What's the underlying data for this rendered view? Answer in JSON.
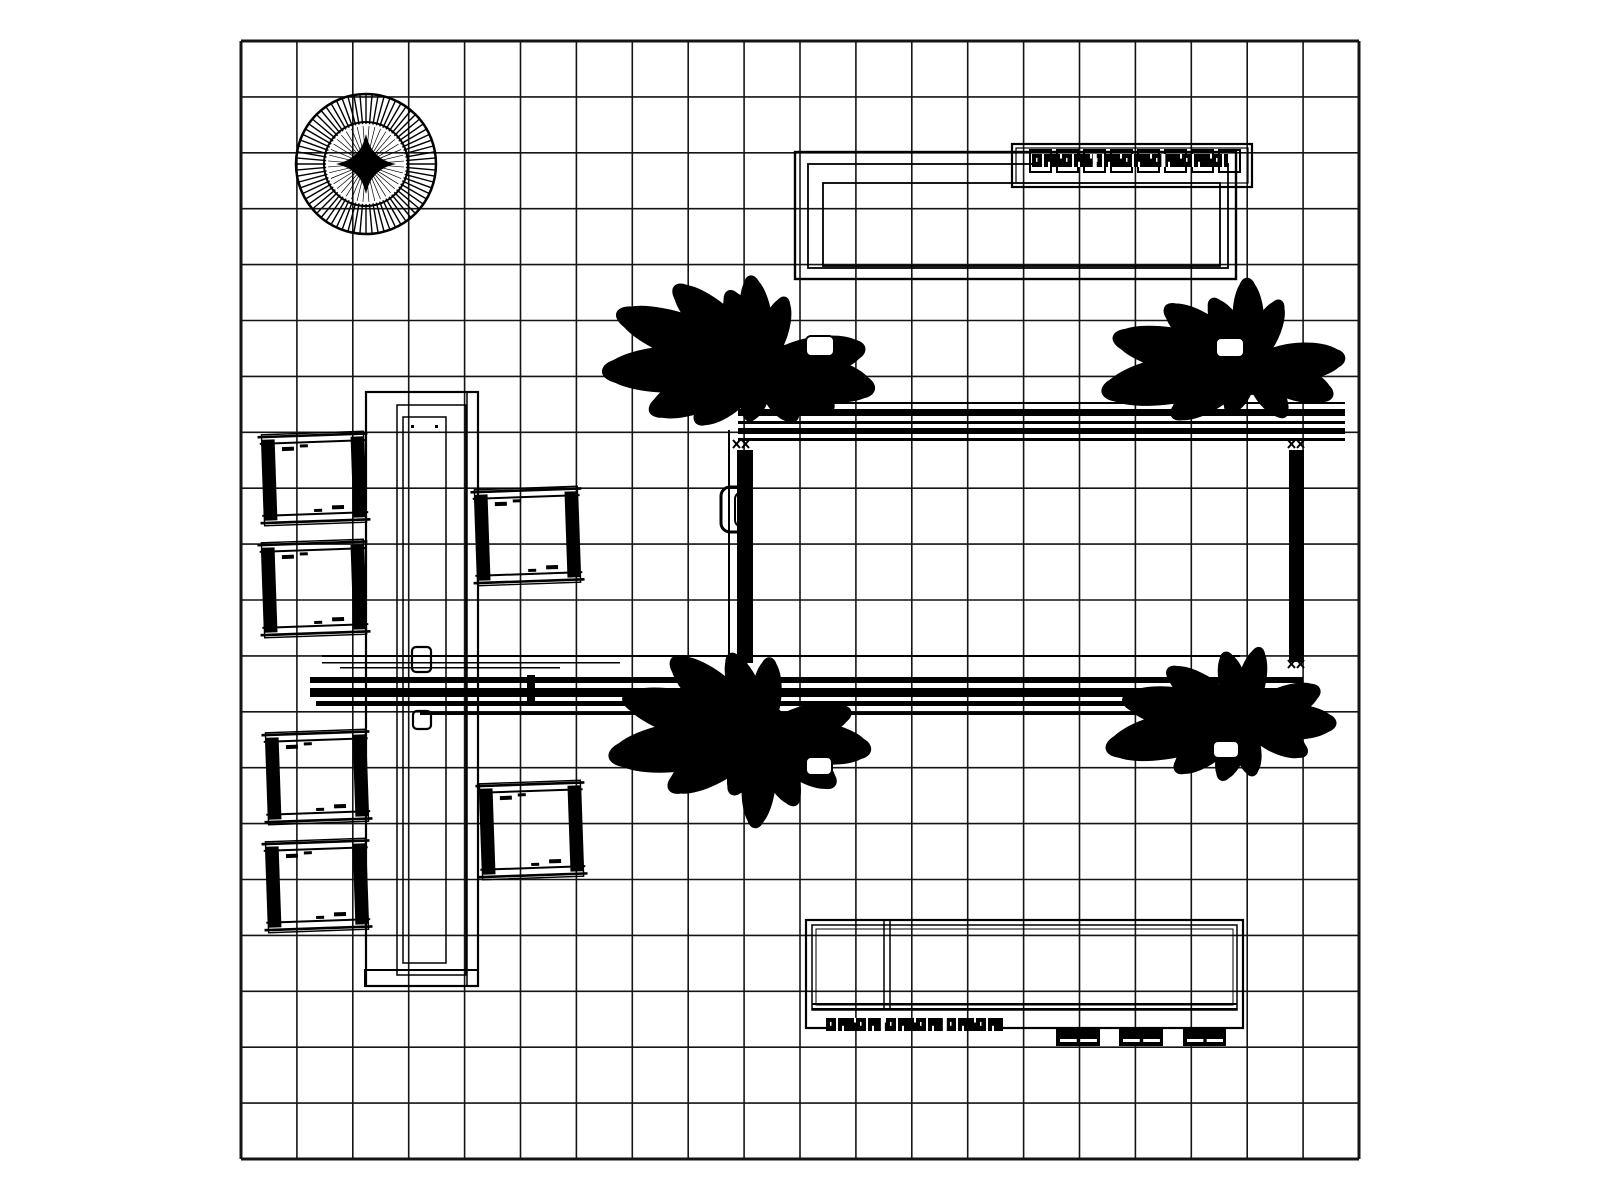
{
  "drawing": {
    "kind": "booth-floor-plan",
    "background": "#ffffff",
    "ink": "#000000",
    "grid_color": "#141414"
  },
  "canvas": {
    "width": 1600,
    "height": 1200
  },
  "grid": {
    "x": 241,
    "y": 41,
    "cols": 20,
    "rows": 20,
    "cell": 55.9,
    "line_width": 1.6,
    "border_width": 3
  },
  "elements": [
    {
      "name": "round-plant-symbol",
      "type": "round-tree",
      "cx": 366,
      "cy": 164,
      "r_outer": 70,
      "r_inner": 42,
      "spokes": 72,
      "inner_spokes": 40,
      "star_r": 30
    },
    {
      "name": "meeting-area-table",
      "type": "nested-rects",
      "rects": [
        [
          795,
          152,
          441,
          127
        ],
        [
          808,
          164,
          420,
          104
        ],
        [
          823,
          183,
          397,
          83
        ]
      ],
      "widths": [
        2.4,
        1.8,
        1.8
      ]
    },
    {
      "name": "literature-shelf",
      "type": "shelf",
      "x": 1012,
      "y": 144,
      "w": 240,
      "h": 43,
      "squares": 8,
      "sq_x": 1030,
      "sq_y": 150,
      "sq_w": 21,
      "sq_h": 22,
      "sq_gap": 6,
      "scribble": [
        1032,
        154,
        196,
        13
      ]
    },
    {
      "name": "overhead-rail-top",
      "type": "hlines",
      "lines": [
        [
          738,
          402,
          1345,
          2
        ],
        [
          738,
          409,
          1345,
          7
        ],
        [
          738,
          421,
          1345,
          3
        ],
        [
          738,
          428,
          1345,
          6
        ],
        [
          738,
          438,
          1345,
          3
        ]
      ]
    },
    {
      "name": "overhead-rail-bottom",
      "type": "hlines",
      "lines": [
        [
          322,
          655,
          1240,
          2
        ],
        [
          322,
          662,
          620,
          1.5
        ],
        [
          340,
          667,
          560,
          1.5
        ],
        [
          310,
          677,
          1303,
          6
        ],
        [
          310,
          688,
          1303,
          9
        ],
        [
          316,
          701,
          1250,
          5
        ],
        [
          420,
          712,
          1200,
          3
        ]
      ]
    },
    {
      "name": "rail-tick",
      "type": "fillrect",
      "rect": [
        527,
        675,
        8,
        26
      ]
    },
    {
      "name": "frame-post-left",
      "type": "vpost",
      "x": 737,
      "y": 450,
      "w": 16,
      "h": 213,
      "thin_x": 729,
      "thin_y1": 430,
      "thin_y2": 672
    },
    {
      "name": "frame-post-right",
      "type": "vpost",
      "x": 1289,
      "y": 450,
      "w": 15,
      "h": 212
    },
    {
      "name": "frame-connector-tl",
      "type": "x-mark",
      "x": 733,
      "y": 440
    },
    {
      "name": "frame-connector-tr",
      "type": "x-mark",
      "x": 1288,
      "y": 440
    },
    {
      "name": "frame-connector-bl",
      "type": "x-mark",
      "x": 733,
      "y": 660
    },
    {
      "name": "frame-connector-br",
      "type": "x-mark",
      "x": 1288,
      "y": 660
    },
    {
      "name": "door-handle",
      "type": "handle",
      "outer": [
        721,
        487,
        30,
        45
      ],
      "inner": [
        735,
        492,
        17,
        35
      ]
    },
    {
      "name": "display-tower",
      "type": "tower",
      "rects": [
        [
          366,
          392,
          112,
          594
        ],
        [
          397,
          405,
          69,
          570
        ],
        [
          403,
          417,
          43,
          546
        ]
      ],
      "vline": [
        467,
        392,
        986
      ],
      "base_bar": [
        365,
        970,
        113,
        16
      ]
    },
    {
      "name": "tower-clamp-upper",
      "type": "clamp",
      "rect": [
        412,
        647,
        19,
        25
      ]
    },
    {
      "name": "tower-clamp-lower",
      "type": "clamp",
      "rect": [
        413,
        711,
        18,
        18
      ]
    },
    {
      "name": "chair",
      "type": "chair",
      "x": 263,
      "y": 433,
      "w": 102,
      "h": 91
    },
    {
      "name": "chair",
      "type": "chair",
      "x": 263,
      "y": 541,
      "w": 102,
      "h": 95
    },
    {
      "name": "chair",
      "type": "chair",
      "x": 267,
      "y": 731,
      "w": 100,
      "h": 92
    },
    {
      "name": "chair",
      "type": "chair",
      "x": 267,
      "y": 840,
      "w": 100,
      "h": 91
    },
    {
      "name": "chair",
      "type": "chair",
      "x": 476,
      "y": 488,
      "w": 103,
      "h": 96
    },
    {
      "name": "chair",
      "type": "chair",
      "x": 481,
      "y": 782,
      "w": 101,
      "h": 96
    },
    {
      "name": "reception-counter",
      "type": "counter",
      "rects": [
        [
          806,
          920,
          437,
          108
        ],
        [
          812,
          925,
          425,
          85
        ],
        [
          816,
          929,
          417,
          76
        ]
      ],
      "divider_x": [
        884,
        890
      ],
      "divider_y": [
        920,
        1010
      ],
      "bottom_lines": [
        [
          812,
          1003,
          1237,
          2
        ],
        [
          812,
          1008,
          1237,
          2
        ]
      ],
      "scribble": [
        826,
        1018,
        177,
        13
      ],
      "boxes": [
        [
          1056,
          1028,
          44,
          18
        ],
        [
          1119,
          1028,
          44,
          18
        ],
        [
          1183,
          1028,
          43,
          18
        ]
      ]
    },
    {
      "name": "palm-plant",
      "type": "palm",
      "cx": 763,
      "cy": 366,
      "core_r": 30,
      "fronds": [
        [
          178,
          155,
          24
        ],
        [
          200,
          150,
          23
        ],
        [
          158,
          118,
          21
        ],
        [
          222,
          115,
          20
        ],
        [
          140,
          85,
          18
        ],
        [
          245,
          80,
          16
        ],
        [
          12,
          110,
          22
        ],
        [
          350,
          100,
          20
        ],
        [
          32,
          80,
          18
        ],
        [
          60,
          62,
          16
        ],
        [
          262,
          88,
          16
        ],
        [
          288,
          70,
          14
        ],
        [
          105,
          55,
          14
        ]
      ]
    },
    {
      "name": "palm-plant",
      "type": "palm",
      "cx": 1250,
      "cy": 366,
      "core_r": 29,
      "fronds": [
        [
          170,
          145,
          24
        ],
        [
          192,
          135,
          22
        ],
        [
          215,
          100,
          19
        ],
        [
          147,
          90,
          18
        ],
        [
          355,
          92,
          19
        ],
        [
          20,
          85,
          18
        ],
        [
          240,
          75,
          15
        ],
        [
          268,
          85,
          16
        ],
        [
          295,
          70,
          14
        ],
        [
          55,
          60,
          14
        ],
        [
          115,
          50,
          13
        ]
      ]
    },
    {
      "name": "palm-plant",
      "type": "palm",
      "cx": 763,
      "cy": 735,
      "core_r": 30,
      "fronds": [
        [
          172,
          150,
          25
        ],
        [
          195,
          140,
          23
        ],
        [
          150,
          105,
          20
        ],
        [
          220,
          115,
          21
        ],
        [
          248,
          85,
          16
        ],
        [
          8,
          105,
          21
        ],
        [
          345,
          88,
          18
        ],
        [
          35,
          85,
          18
        ],
        [
          65,
          75,
          16
        ],
        [
          95,
          90,
          17
        ],
        [
          118,
          65,
          15
        ],
        [
          275,
          75,
          15
        ]
      ]
    },
    {
      "name": "palm-plant",
      "type": "palm",
      "cx": 1243,
      "cy": 720,
      "core_r": 28,
      "fronds": [
        [
          168,
          135,
          23
        ],
        [
          190,
          118,
          21
        ],
        [
          214,
          88,
          17
        ],
        [
          143,
          82,
          17
        ],
        [
          2,
          90,
          18
        ],
        [
          338,
          80,
          17
        ],
        [
          28,
          70,
          15
        ],
        [
          255,
          68,
          14
        ],
        [
          283,
          72,
          14
        ],
        [
          110,
          62,
          14
        ],
        [
          80,
          55,
          13
        ]
      ]
    },
    {
      "name": "planter-pot",
      "type": "pot",
      "rect": [
        806,
        336,
        28,
        20
      ]
    },
    {
      "name": "planter-pot",
      "type": "pot",
      "rect": [
        1216,
        338,
        28,
        19
      ]
    },
    {
      "name": "planter-pot",
      "type": "pot",
      "rect": [
        806,
        757,
        26,
        18
      ]
    },
    {
      "name": "planter-pot",
      "type": "pot",
      "rect": [
        1213,
        741,
        26,
        17
      ]
    }
  ]
}
